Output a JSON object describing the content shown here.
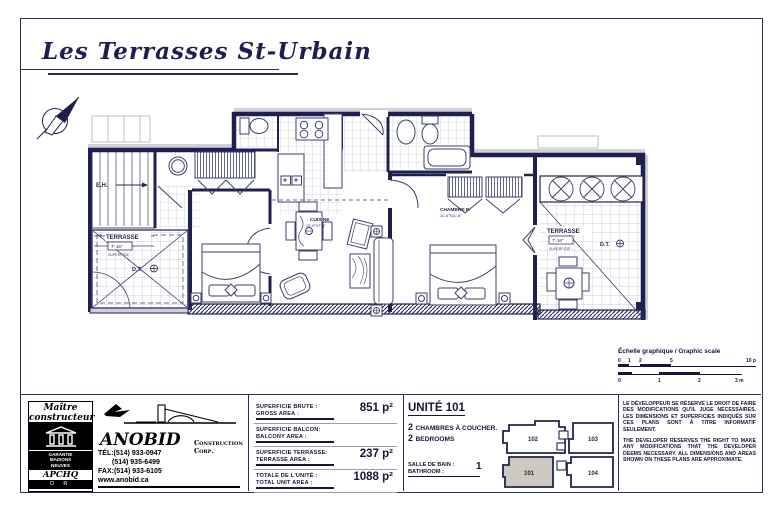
{
  "title": "Les Terrasses St-Urbain",
  "plan": {
    "labels": {
      "stairs": "E.H.",
      "terrace_left": "TERRASSE",
      "terrace_left_dim": "7'-16\"",
      "terrace_left_note": "SUPERFICIE :",
      "drain_left": "D.T.",
      "kitchen": "CUISINE",
      "kitchen_dim": "10'-0\"X7'-6\"",
      "bedroom": "CHAMBRE P.",
      "bedroom_dim": "11'-0\"X11'-6\"",
      "terrace_right": "TERRASSE",
      "terrace_right_dim": "7'-16\"",
      "terrace_right_note": "SUPERFICIE :",
      "drain_right": "D.T."
    }
  },
  "scale": {
    "title": "Échelle graphique / Graphic scale",
    "feet_ticks": [
      "0",
      "1",
      "2",
      "5",
      "10 p"
    ],
    "meter_ticks": [
      "0",
      "1",
      "2",
      "3 m"
    ]
  },
  "builder_badge": {
    "line1": "Maître",
    "line2": "constructeur",
    "guarantee_1": "GARANTIE",
    "guarantee_2": "MAISONS",
    "guarantee_3": "NEUVES",
    "assoc": "APCHQ",
    "level": "O R"
  },
  "company": {
    "name": "ANOBID",
    "suffix": "Construction Corp.",
    "tel1": "TÉL:(514) 933-0947",
    "tel2": "(514) 935-6499",
    "fax": "FAX:(514) 933-6105",
    "web": "www.anobid.ca"
  },
  "areas": {
    "rows": [
      {
        "fr": "SUPERFICIE BRUTE :",
        "en": "GROSS AREA :",
        "value": "851 p²"
      },
      {
        "fr": "SUPERFICIE BALCON:",
        "en": "BALCONY AREA :",
        "value": ""
      },
      {
        "fr": "SUPERFICIE TERRASSE:",
        "en": "TERRASSE AREA :",
        "value": "237 p²"
      },
      {
        "fr": "TOTALE DE L'UNITÉ :",
        "en": "TOTAL UNIT AREA :",
        "value": "1088 p²"
      }
    ]
  },
  "unit": {
    "title": "UNITÉ 101",
    "bedrooms_count": "2",
    "bedrooms_fr": "CHAMBRES À COUCHER.",
    "bedrooms_en": "BEDROOMS",
    "bath_fr": "SALLE DE BAIN :",
    "bath_en": "BATHROOM :",
    "bath_count": "1"
  },
  "keyplan": {
    "top_left": "102",
    "top_right": "103",
    "bottom_left": "101",
    "bottom_right": "104",
    "highlight": "101",
    "highlight_color": "#cdc9c0"
  },
  "legal": {
    "fr": "LE DÉVELOPPEUR SE RÉSERVE LE DROIT DE FAIRE DES MODIFICATIONS QU'IL JUGE NÉCESSAIRES. LES DIMENSIONS ET SUPERFICIES INDIQUÉS SUR CES PLANS SONT À TITRE INFORMATIF SEULEMENT.",
    "en": "THE DEVELOPER RESERVES THE RIGHT TO MAKE ANY MODIFICATIONS THAT THE DEVELOPER DEEMS NECESSARY. ALL DIMENSIONS AND AREAS SHOWN ON THESE PLANS ARE APPROXIMATE."
  },
  "colors": {
    "ink": "#21244f",
    "wall": "#1e2150",
    "shade": "#cdc9c0",
    "halo": "#d0d0d8"
  }
}
